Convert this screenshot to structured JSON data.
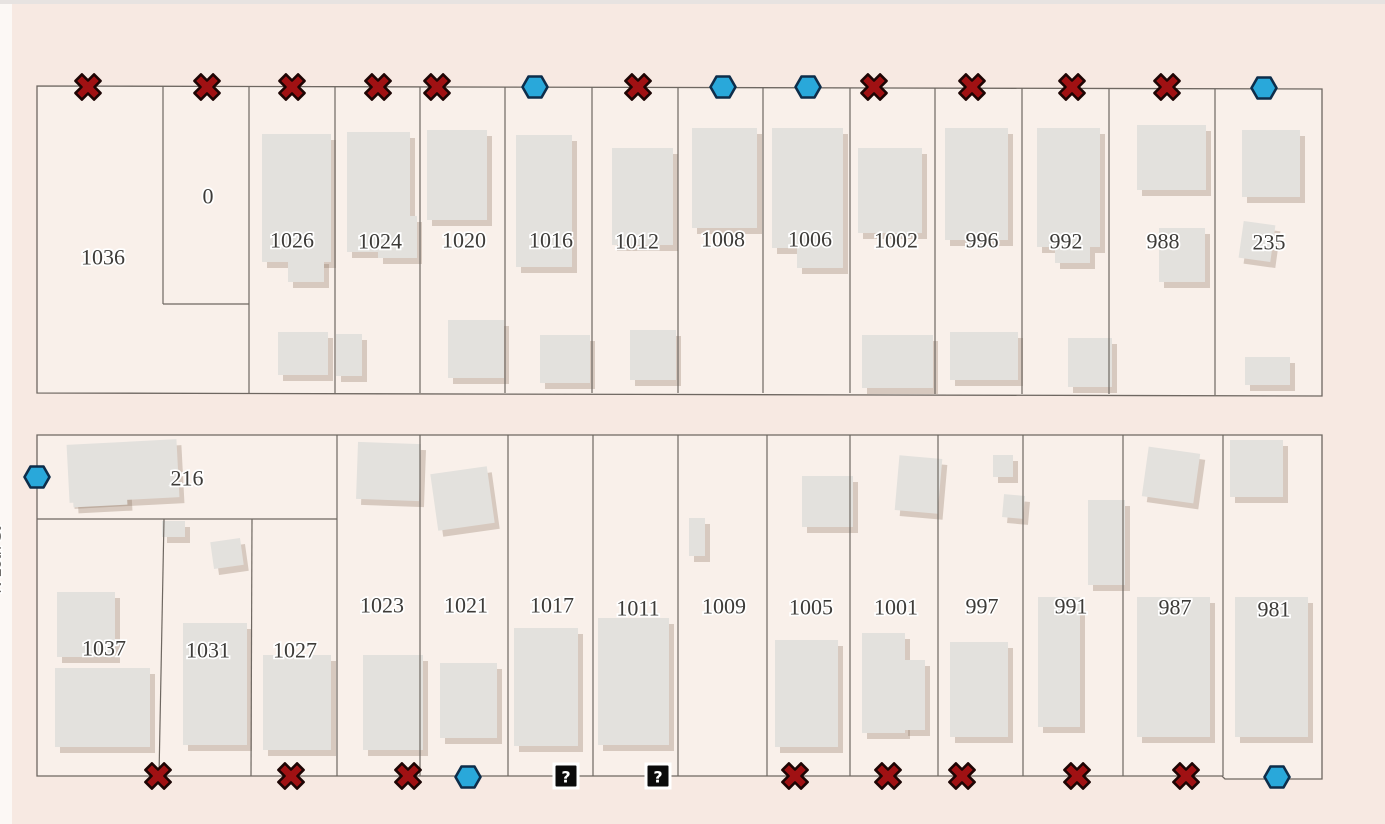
{
  "map": {
    "background": "#f7e9e2",
    "parcel_fill": "#f9f0ea",
    "line_color": "#6e6761",
    "building_fill": "#e3e1dd",
    "building_shadow": "rgba(136,112,92,0.30)",
    "label_color": "#3d3b38",
    "label_halo": "#ffffff",
    "top_strip_color": "#e7e3e1",
    "left_strip_color": "#fcf8f5",
    "left_street_label": "N 10th St",
    "marker_style": {
      "x_fill": "#a01113",
      "x_outline": "#1d0504",
      "hex_fill": "#29a8da",
      "hex_outline": "#0e2d4a",
      "question_bg": "#0b0b0b",
      "question_fg": "#ffffff",
      "question_halo": "#ffffff"
    },
    "blocks": [
      {
        "name": "north-block",
        "points": "37,86 1322,89 1322,396 37,393"
      },
      {
        "name": "south-block",
        "points": "37,435 1322,435 1322,779 1225,779 1222,776 37,776"
      }
    ],
    "inner_lines": [
      [
        163,
        86,
        163,
        304
      ],
      [
        163,
        304,
        249,
        304
      ],
      [
        249,
        87,
        249,
        393
      ],
      [
        335,
        87,
        335,
        393
      ],
      [
        420,
        87,
        420,
        393
      ],
      [
        505,
        87,
        505,
        393
      ],
      [
        592,
        87,
        592,
        393
      ],
      [
        678,
        87,
        678,
        393
      ],
      [
        763,
        88,
        763,
        393
      ],
      [
        850,
        88,
        850,
        393
      ],
      [
        935,
        88,
        935,
        394
      ],
      [
        1022,
        88,
        1022,
        394
      ],
      [
        1109,
        88,
        1109,
        394
      ],
      [
        1215,
        89,
        1215,
        395
      ],
      [
        37,
        519,
        337,
        519
      ],
      [
        337,
        435,
        337,
        776
      ],
      [
        164,
        519,
        159,
        776
      ],
      [
        252,
        519,
        251,
        776
      ],
      [
        420,
        435,
        420,
        776
      ],
      [
        508,
        435,
        508,
        776
      ],
      [
        593,
        435,
        593,
        776
      ],
      [
        678,
        435,
        678,
        776
      ],
      [
        767,
        435,
        767,
        776
      ],
      [
        850,
        435,
        850,
        776
      ],
      [
        938,
        435,
        938,
        776
      ],
      [
        1023,
        435,
        1023,
        776
      ],
      [
        1123,
        435,
        1123,
        776
      ],
      [
        1223,
        435,
        1223,
        776
      ]
    ],
    "buildings": [
      [
        262,
        134,
        69,
        128,
        0
      ],
      [
        288,
        258,
        36,
        24,
        0
      ],
      [
        278,
        332,
        50,
        43,
        0
      ],
      [
        336,
        334,
        26,
        42,
        0
      ],
      [
        347,
        132,
        63,
        120,
        0
      ],
      [
        378,
        216,
        39,
        42,
        0
      ],
      [
        427,
        130,
        60,
        90,
        0
      ],
      [
        448,
        320,
        56,
        58,
        0
      ],
      [
        516,
        135,
        56,
        132,
        0
      ],
      [
        540,
        335,
        50,
        48,
        0
      ],
      [
        612,
        148,
        61,
        97,
        0
      ],
      [
        630,
        330,
        46,
        50,
        0
      ],
      [
        692,
        128,
        65,
        100,
        0
      ],
      [
        772,
        128,
        71,
        120,
        0
      ],
      [
        797,
        248,
        46,
        20,
        0
      ],
      [
        858,
        148,
        64,
        85,
        0
      ],
      [
        862,
        335,
        71,
        53,
        0
      ],
      [
        945,
        128,
        63,
        112,
        0
      ],
      [
        950,
        332,
        68,
        48,
        0
      ],
      [
        1037,
        128,
        63,
        119,
        0
      ],
      [
        1055,
        247,
        35,
        16,
        0
      ],
      [
        1068,
        338,
        44,
        49,
        0
      ],
      [
        1137,
        125,
        69,
        65,
        0
      ],
      [
        1159,
        228,
        46,
        54,
        0
      ],
      [
        1242,
        130,
        58,
        67,
        0
      ],
      [
        1241,
        223,
        32,
        37,
        8
      ],
      [
        1245,
        357,
        45,
        28,
        0
      ],
      [
        68,
        442,
        110,
        58,
        -3
      ],
      [
        73,
        488,
        54,
        18,
        -3
      ],
      [
        57,
        592,
        58,
        65,
        0
      ],
      [
        55,
        668,
        95,
        79,
        0
      ],
      [
        162,
        521,
        23,
        16,
        0
      ],
      [
        212,
        540,
        30,
        27,
        -8
      ],
      [
        183,
        623,
        64,
        122,
        0
      ],
      [
        263,
        655,
        68,
        95,
        0
      ],
      [
        357,
        443,
        63,
        57,
        2
      ],
      [
        363,
        655,
        60,
        95,
        0
      ],
      [
        434,
        470,
        57,
        57,
        -8
      ],
      [
        440,
        663,
        57,
        75,
        0
      ],
      [
        514,
        628,
        64,
        118,
        0
      ],
      [
        598,
        618,
        71,
        127,
        0
      ],
      [
        689,
        518,
        16,
        38,
        0
      ],
      [
        802,
        476,
        51,
        51,
        0
      ],
      [
        775,
        640,
        63,
        107,
        0
      ],
      [
        897,
        457,
        43,
        55,
        5
      ],
      [
        862,
        633,
        43,
        100,
        0
      ],
      [
        903,
        660,
        22,
        70,
        0
      ],
      [
        993,
        455,
        20,
        22,
        0
      ],
      [
        1003,
        495,
        21,
        23,
        5
      ],
      [
        950,
        642,
        58,
        95,
        0
      ],
      [
        1038,
        597,
        42,
        130,
        0
      ],
      [
        1088,
        500,
        37,
        85,
        0
      ],
      [
        1145,
        450,
        52,
        50,
        8
      ],
      [
        1137,
        597,
        73,
        140,
        0
      ],
      [
        1230,
        440,
        53,
        57,
        0
      ],
      [
        1235,
        597,
        73,
        140,
        0
      ]
    ],
    "labels": [
      {
        "text": "1036",
        "x": 103,
        "y": 257
      },
      {
        "text": "0",
        "x": 208,
        "y": 196
      },
      {
        "text": "1026",
        "x": 292,
        "y": 240
      },
      {
        "text": "1024",
        "x": 380,
        "y": 241
      },
      {
        "text": "1020",
        "x": 464,
        "y": 240
      },
      {
        "text": "1016",
        "x": 551,
        "y": 240
      },
      {
        "text": "1012",
        "x": 637,
        "y": 241
      },
      {
        "text": "1008",
        "x": 723,
        "y": 239
      },
      {
        "text": "1006",
        "x": 810,
        "y": 239
      },
      {
        "text": "1002",
        "x": 896,
        "y": 240
      },
      {
        "text": "996",
        "x": 982,
        "y": 240
      },
      {
        "text": "992",
        "x": 1066,
        "y": 241
      },
      {
        "text": "988",
        "x": 1163,
        "y": 241
      },
      {
        "text": "235",
        "x": 1269,
        "y": 242
      },
      {
        "text": "216",
        "x": 187,
        "y": 478
      },
      {
        "text": "1037",
        "x": 104,
        "y": 648
      },
      {
        "text": "1031",
        "x": 208,
        "y": 650
      },
      {
        "text": "1027",
        "x": 295,
        "y": 650
      },
      {
        "text": "1023",
        "x": 382,
        "y": 605
      },
      {
        "text": "1021",
        "x": 466,
        "y": 605
      },
      {
        "text": "1017",
        "x": 552,
        "y": 605
      },
      {
        "text": "1011",
        "x": 638,
        "y": 608
      },
      {
        "text": "1009",
        "x": 724,
        "y": 606
      },
      {
        "text": "1005",
        "x": 811,
        "y": 607
      },
      {
        "text": "1001",
        "x": 896,
        "y": 607
      },
      {
        "text": "997",
        "x": 982,
        "y": 606
      },
      {
        "text": "991",
        "x": 1071,
        "y": 606
      },
      {
        "text": "987",
        "x": 1175,
        "y": 607
      },
      {
        "text": "981",
        "x": 1274,
        "y": 609
      }
    ],
    "markers": [
      {
        "t": "x",
        "x": 88,
        "y": 87
      },
      {
        "t": "x",
        "x": 207,
        "y": 87
      },
      {
        "t": "x",
        "x": 292,
        "y": 87
      },
      {
        "t": "x",
        "x": 378,
        "y": 87
      },
      {
        "t": "x",
        "x": 437,
        "y": 87
      },
      {
        "t": "h",
        "x": 535,
        "y": 87
      },
      {
        "t": "x",
        "x": 638,
        "y": 87
      },
      {
        "t": "h",
        "x": 723,
        "y": 87
      },
      {
        "t": "h",
        "x": 808,
        "y": 87
      },
      {
        "t": "x",
        "x": 874,
        "y": 87
      },
      {
        "t": "x",
        "x": 972,
        "y": 87
      },
      {
        "t": "x",
        "x": 1072,
        "y": 87
      },
      {
        "t": "x",
        "x": 1167,
        "y": 87
      },
      {
        "t": "h",
        "x": 1264,
        "y": 88
      },
      {
        "t": "h",
        "x": 37,
        "y": 477
      },
      {
        "t": "x",
        "x": 158,
        "y": 776
      },
      {
        "t": "x",
        "x": 291,
        "y": 776
      },
      {
        "t": "x",
        "x": 408,
        "y": 776
      },
      {
        "t": "h",
        "x": 468,
        "y": 777
      },
      {
        "t": "q",
        "x": 566,
        "y": 776
      },
      {
        "t": "q",
        "x": 658,
        "y": 776
      },
      {
        "t": "x",
        "x": 795,
        "y": 776
      },
      {
        "t": "x",
        "x": 888,
        "y": 776
      },
      {
        "t": "x",
        "x": 962,
        "y": 776
      },
      {
        "t": "x",
        "x": 1077,
        "y": 776
      },
      {
        "t": "x",
        "x": 1186,
        "y": 776
      },
      {
        "t": "h",
        "x": 1277,
        "y": 777
      }
    ]
  }
}
